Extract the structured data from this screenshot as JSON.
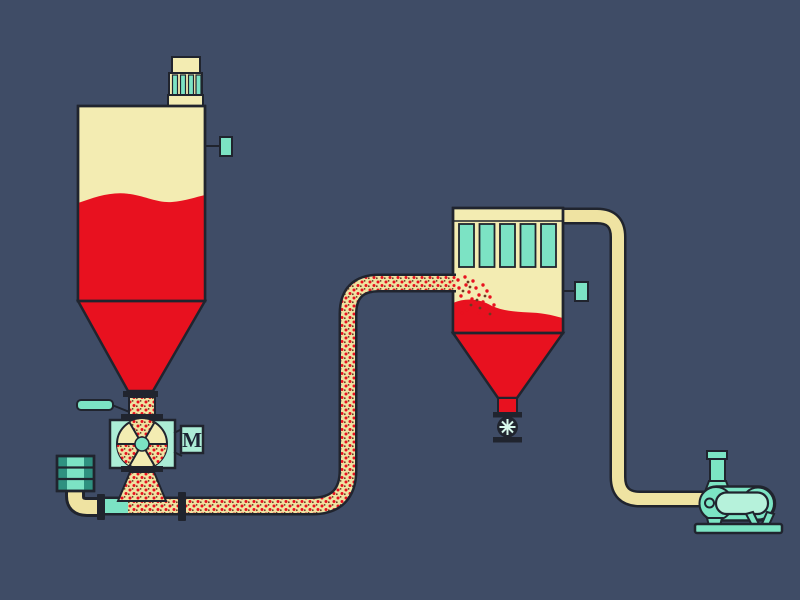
{
  "diagram": {
    "kind": "pneumatic-conveying-system-flow-diagram"
  },
  "motor": {
    "label": "M"
  },
  "colors": {
    "bg": "#3F4C66",
    "outline": "#20242E",
    "cream": "#F3ECB2",
    "cream_deep": "#EFE3A2",
    "red": "#E8111F",
    "mint": "#ACEDD6",
    "teal": "#7CE3C4",
    "teal_dark": "#2F9180",
    "blower": "#7CE5C4",
    "blower_light": "#B6F2DB",
    "ink": "#1C2534",
    "dot_dark": "#6B3A22",
    "spoke": "#D8F8EC"
  },
  "components": [
    "storage-silo",
    "silo-vent-filter",
    "silo-level-sensor",
    "slide-gate-handle",
    "rotary-valve-feeder",
    "feeder-motor",
    "intake-air-silencer",
    "conveying-pipeline",
    "filter-receiver",
    "receiver-filter-bags",
    "receiver-level-sensor",
    "receiver-discharge-valve",
    "exhaust-air-pipeline",
    "vacuum-blower"
  ]
}
